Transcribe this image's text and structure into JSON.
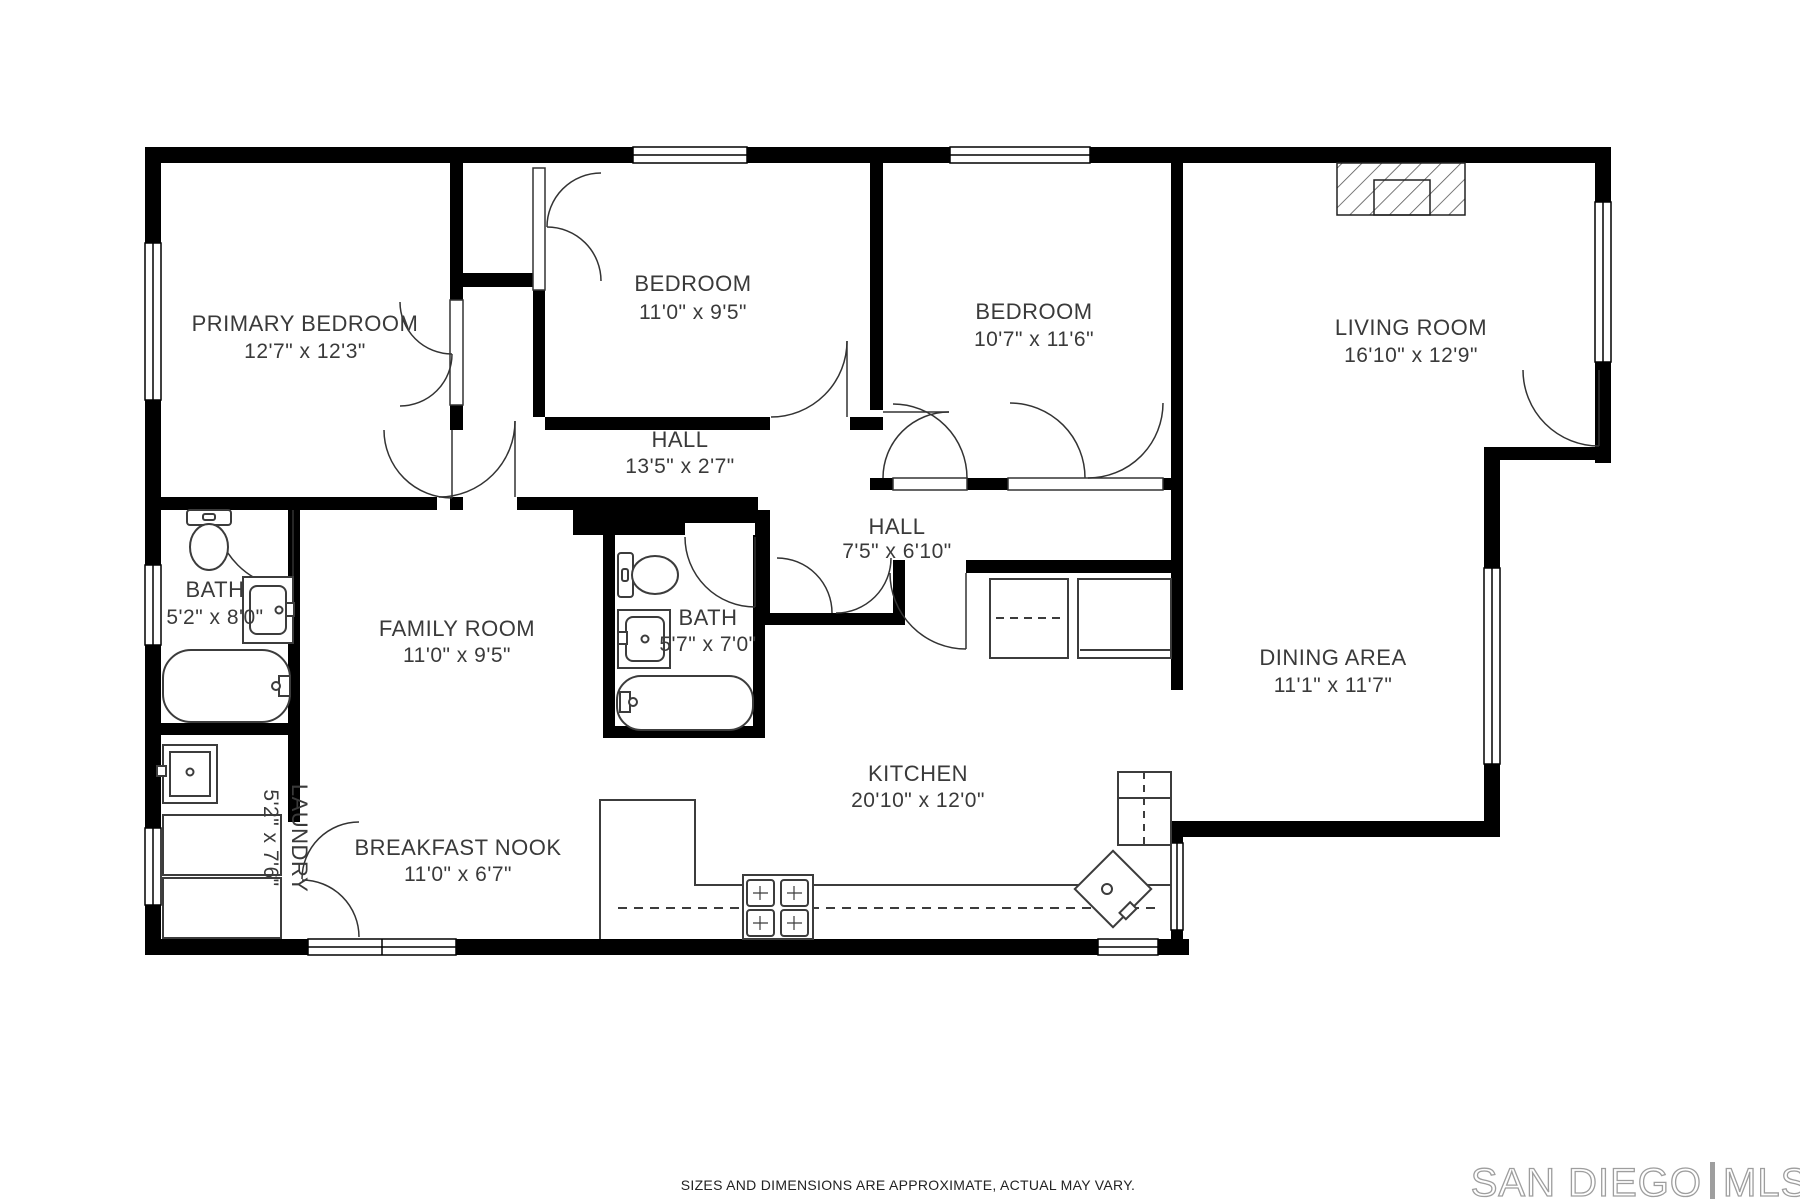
{
  "plan": {
    "type": "residential-floor-plan",
    "colors": {
      "wall": "#000000",
      "label": "#3a3a3a",
      "fixture_line": "#3c3c3c",
      "logo_gray": "#9e9e9e"
    },
    "rooms": [
      {
        "id": "primary-bedroom",
        "name": "PRIMARY BEDROOM",
        "dims": "12'7\" x 12'3\""
      },
      {
        "id": "bedroom-1",
        "name": "BEDROOM",
        "dims": "11'0\" x 9'5\""
      },
      {
        "id": "bedroom-2",
        "name": "BEDROOM",
        "dims": "10'7\" x 11'6\""
      },
      {
        "id": "living-room",
        "name": "LIVING ROOM",
        "dims": "16'10\" x 12'9\""
      },
      {
        "id": "hall-1",
        "name": "HALL",
        "dims": "13'5\" x 2'7\""
      },
      {
        "id": "hall-2",
        "name": "HALL",
        "dims": "7'5\" x 6'10\""
      },
      {
        "id": "bath-1",
        "name": "BATH",
        "dims": "5'2\" x 8'0\""
      },
      {
        "id": "family-room",
        "name": "FAMILY ROOM",
        "dims": "11'0\" x 9'5\""
      },
      {
        "id": "bath-2",
        "name": "BATH",
        "dims": "5'7\" x 7'0\""
      },
      {
        "id": "dining-area",
        "name": "DINING AREA",
        "dims": "11'1\" x 11'7\""
      },
      {
        "id": "kitchen",
        "name": "KITCHEN",
        "dims": "20'10\" x 12'0\""
      },
      {
        "id": "breakfast-nook",
        "name": "BREAKFAST NOOK",
        "dims": "11'0\" x 6'7\""
      },
      {
        "id": "laundry",
        "name": "LAUNDRY",
        "dims": "5'2\" x 7'6\""
      }
    ]
  },
  "footer": {
    "disclaimer": "SIZES AND DIMENSIONS ARE APPROXIMATE, ACTUAL MAY VARY."
  },
  "branding": {
    "left": "SAN DIEGO",
    "right": "MLS"
  }
}
